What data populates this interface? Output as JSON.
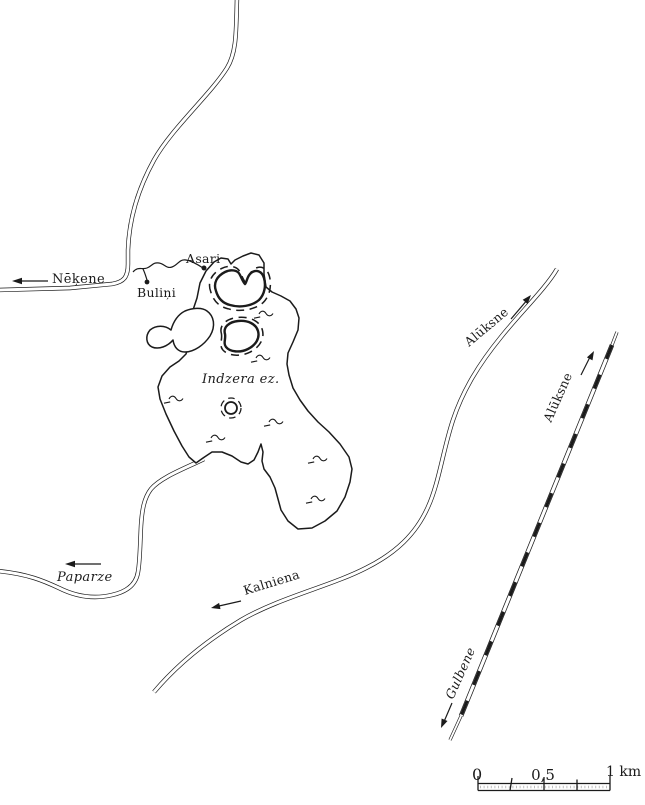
{
  "figure": {
    "type": "scanned line map of Indzera lake area (Gulbene district, Latvia)",
    "background_color": "#ffffff",
    "ink_color": "#1b1b1b"
  },
  "labels": {
    "nekene": "Nēķene",
    "bulini": "Buliņi",
    "asari": "Asari",
    "lake": "Indzera ez.",
    "paparze": "Paparze",
    "kalniena": "Kalniena",
    "aliksne_road": "Alūksne",
    "aliksne_rail": "Alūksne",
    "gulbene": "Gulbene"
  },
  "scalebar": {
    "zero": "0",
    "half": "0,5",
    "one_km": "1 km"
  }
}
